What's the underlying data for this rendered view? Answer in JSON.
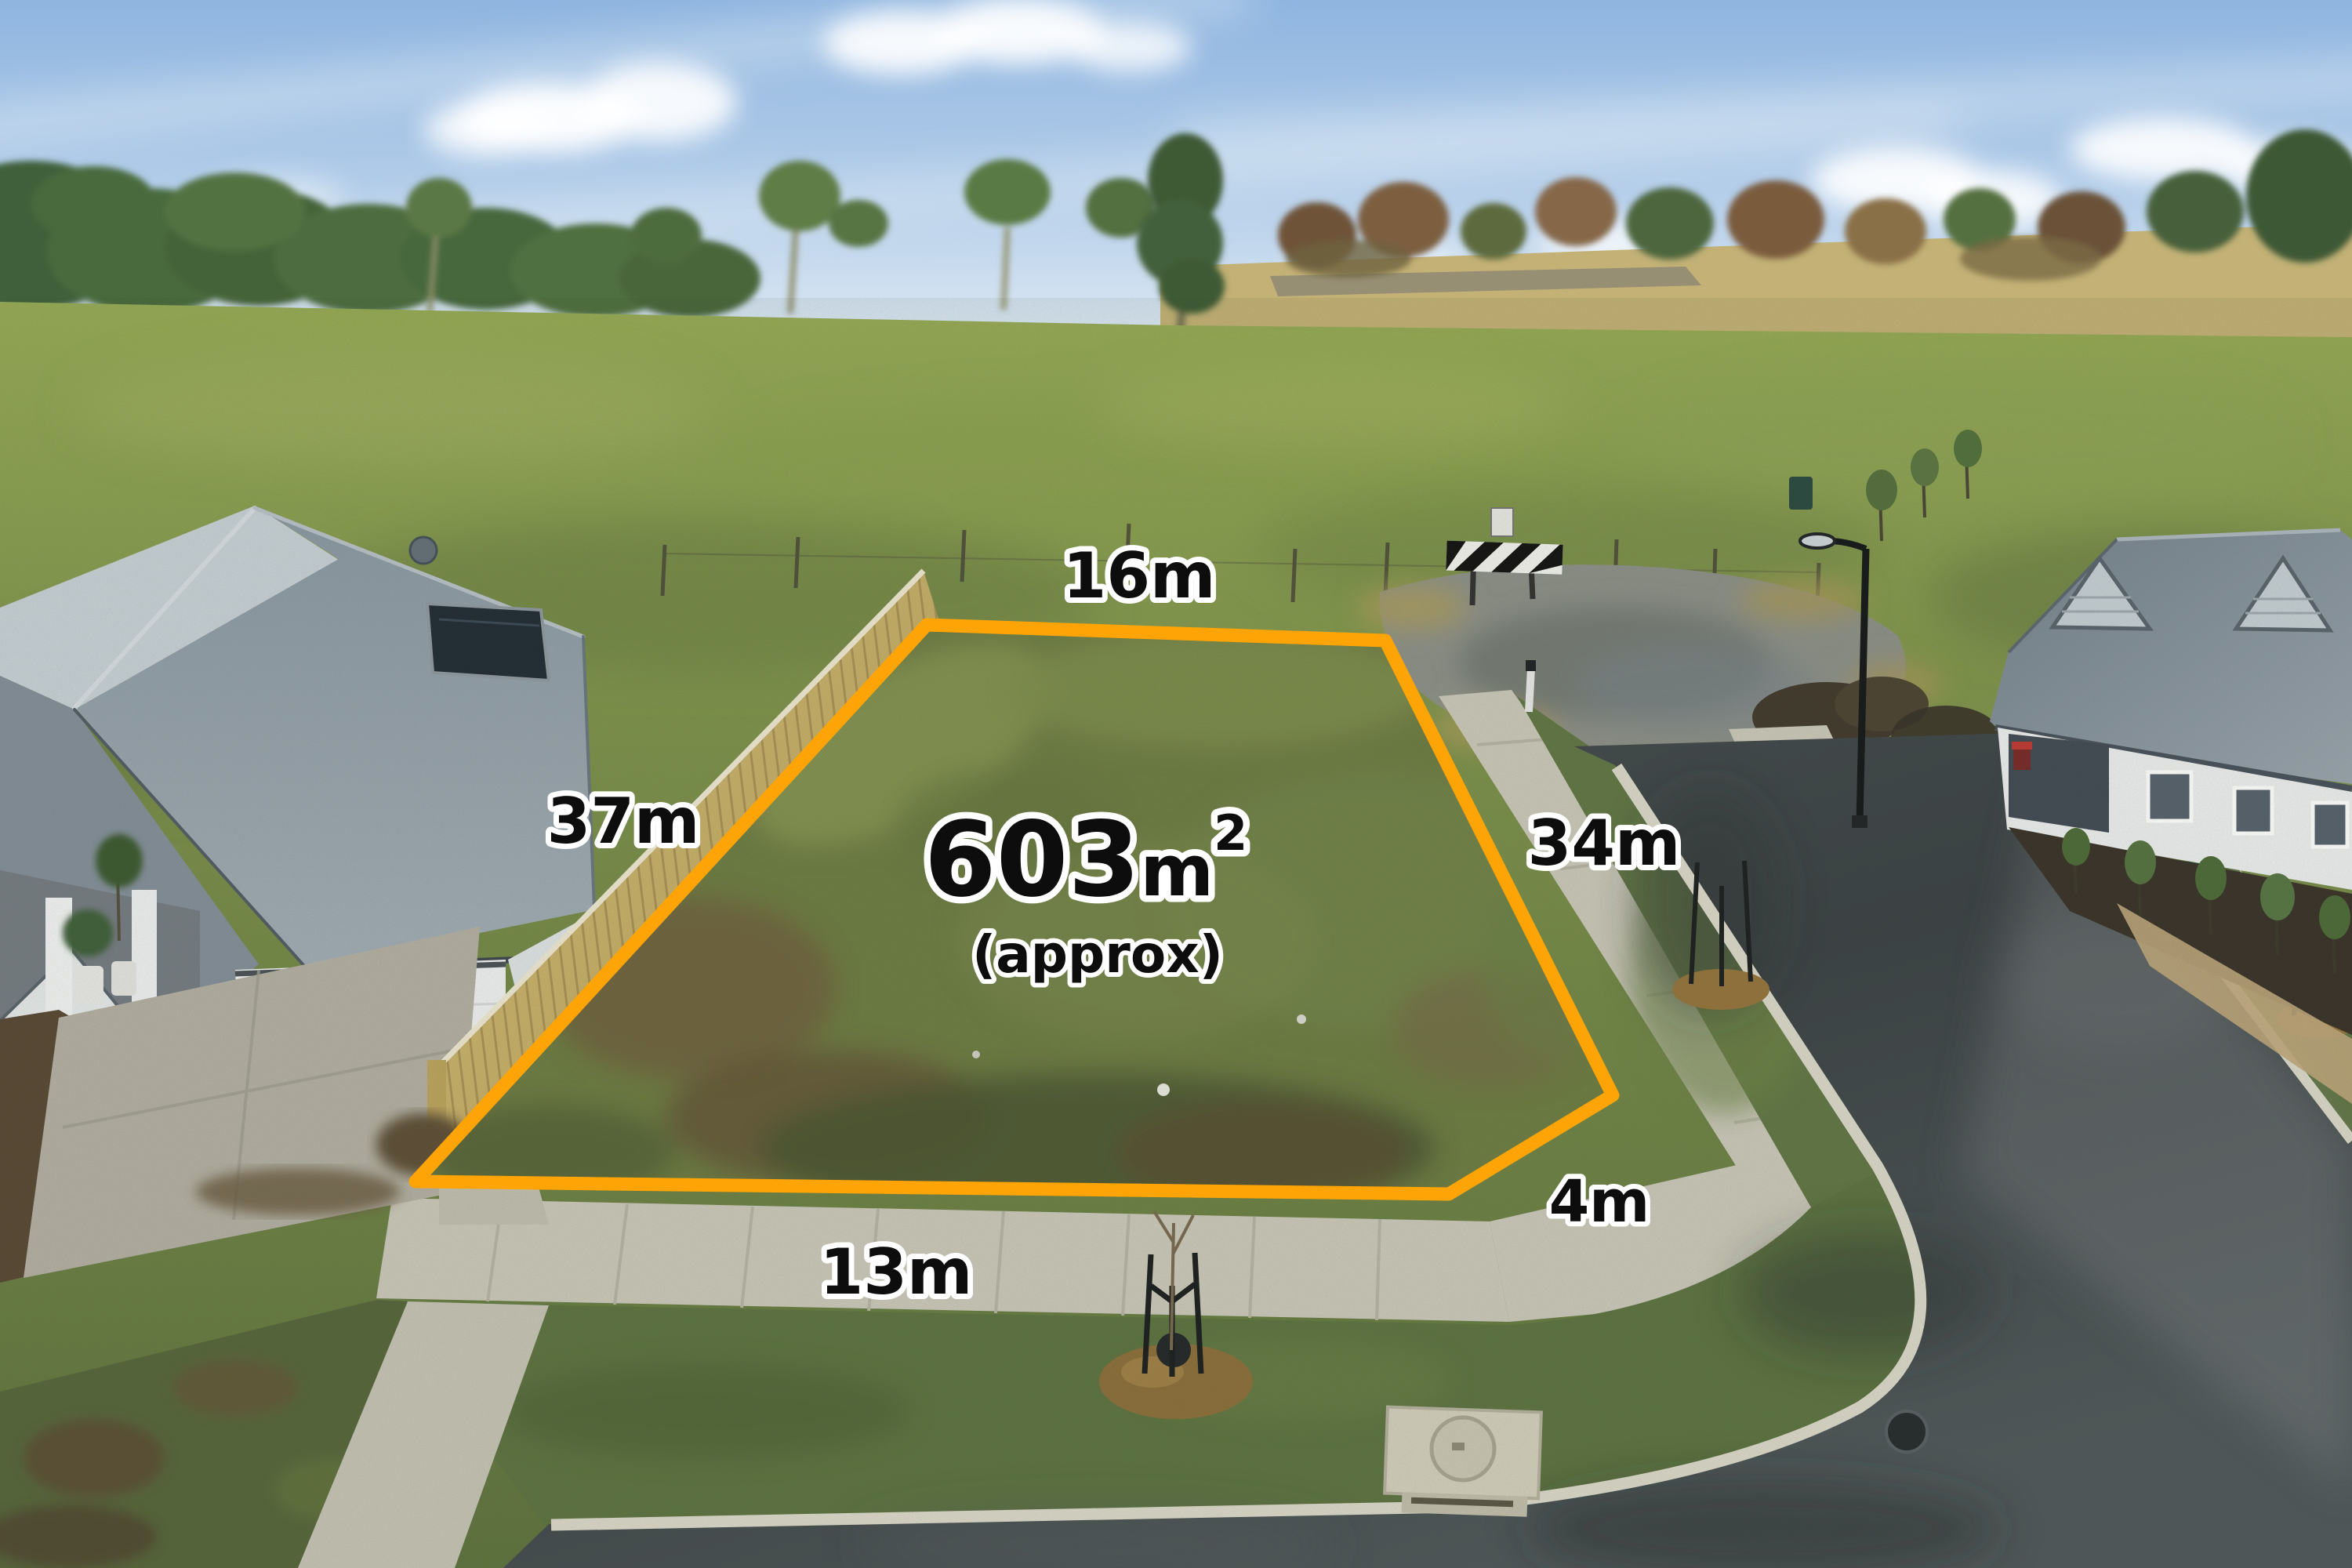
{
  "annotation": {
    "boundary_color": "#FFA407",
    "label_text_color": "#0d0d0d",
    "label_outline_color": "#FFFFFF",
    "area": {
      "value": "603",
      "unit": "m",
      "superscript": "2",
      "qualifier": "(approx)"
    },
    "dimensions": {
      "top": "16m",
      "left": "37m",
      "right": "34m",
      "bottom": "13m",
      "corner": "4m"
    }
  },
  "scene": {
    "sky_color": "#9dbfe4",
    "pasture_color": "#7d914c",
    "lot_grass_color": "#6e7c44",
    "road_color": "#43494c",
    "concrete_color": "#cbc8ba",
    "fence_color": "#c8af6a",
    "roof_color": "#8e99a4",
    "mulch_color": "#96743d",
    "soil_color": "#55462f"
  }
}
